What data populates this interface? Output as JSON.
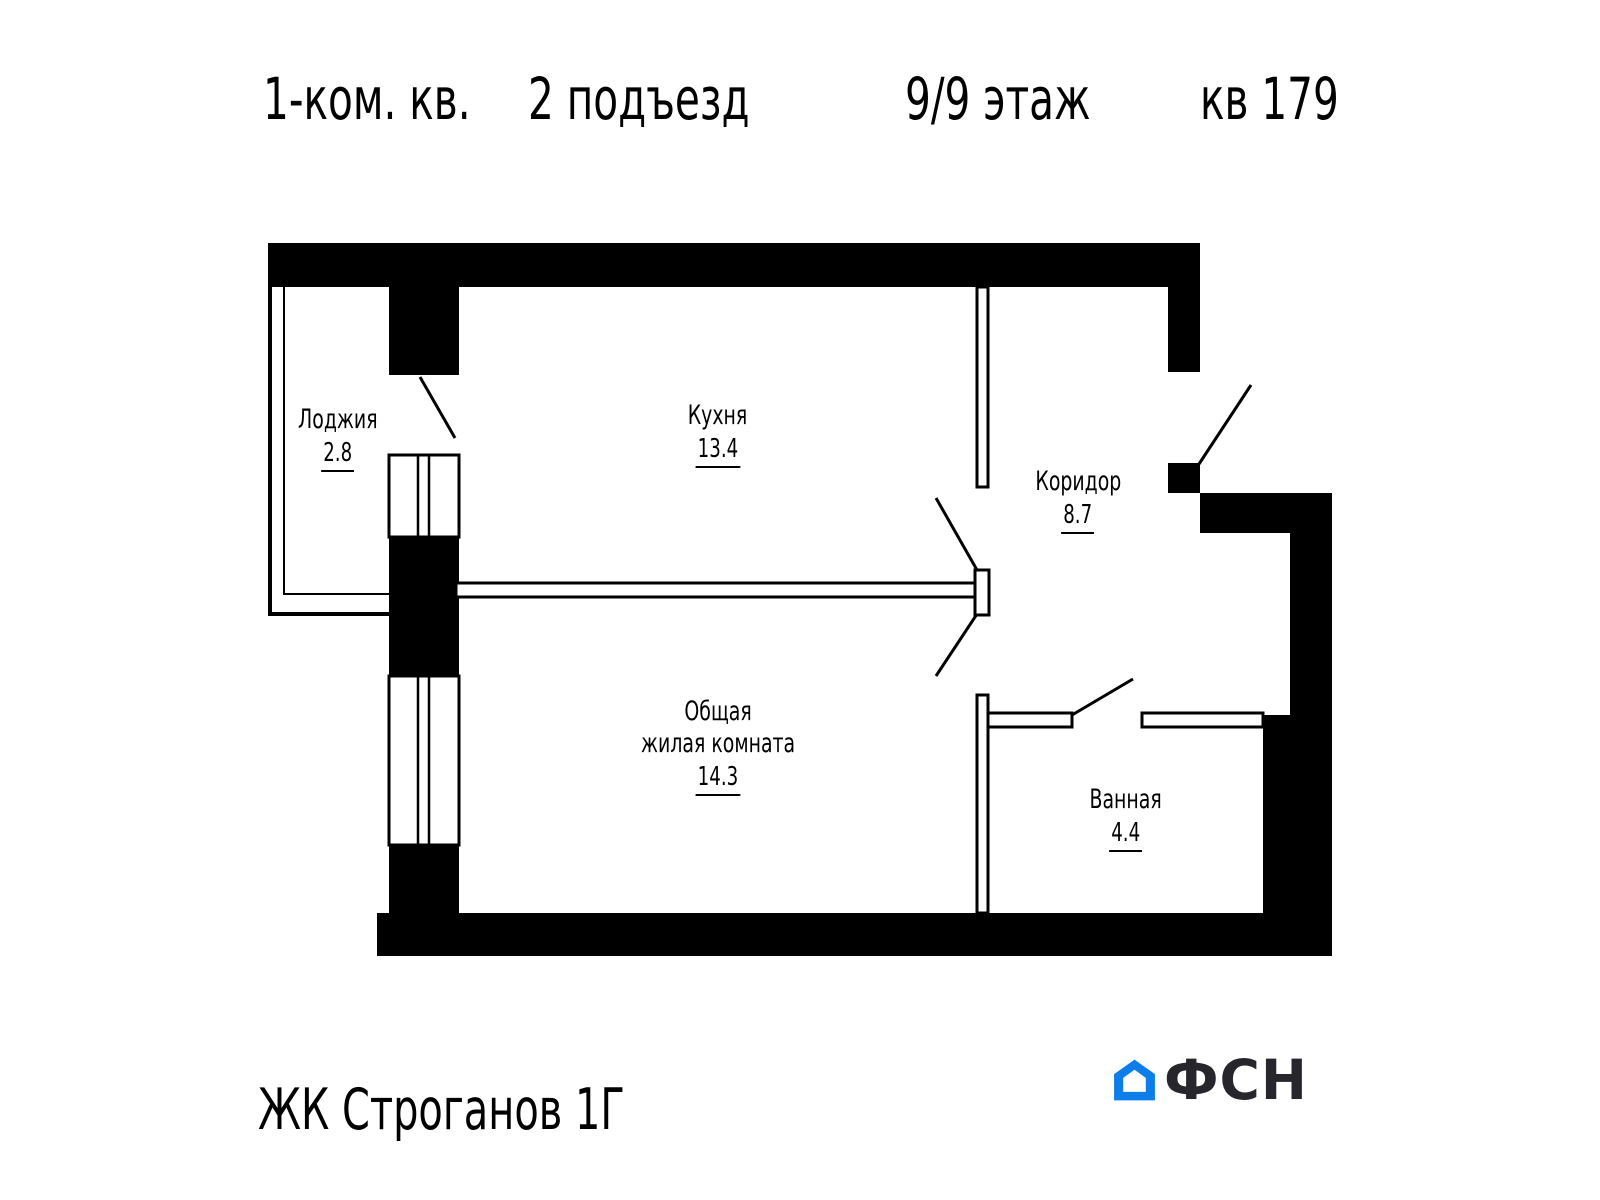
{
  "title": {
    "rooms_type": "1-ком. кв.",
    "entrance": "2 подъезд",
    "floor": "9/9 этаж",
    "apartment": "кв 179"
  },
  "rooms": {
    "loggia": {
      "name": "Лоджия",
      "area": "2.8"
    },
    "kitchen": {
      "name": "Кухня",
      "area": "13.4"
    },
    "corridor": {
      "name": "Коридор",
      "area": "8.7"
    },
    "living": {
      "name_line1": "Общая",
      "name_line2": "жилая комната",
      "area": "14.3"
    },
    "bathroom": {
      "name": "Ванная",
      "area": "4.4"
    }
  },
  "footer": {
    "complex": "ЖК Строганов 1Г",
    "brand": "ФСН"
  },
  "colors": {
    "wall": "#000000",
    "logoBlue": "#0d7de9",
    "logoText": "#26262c"
  }
}
